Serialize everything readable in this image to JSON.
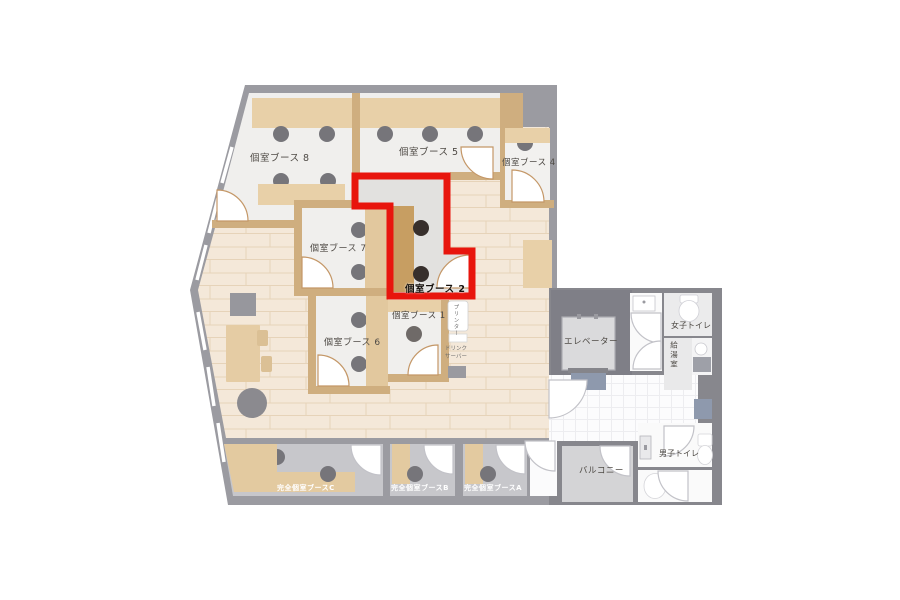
{
  "floor_plan": {
    "booths": {
      "booth8": "個室ブース 8",
      "booth5": "個室ブース 5",
      "booth4": "個室ブース 4",
      "booth7": "個室ブース 7",
      "booth2": "個室ブース 2",
      "booth6": "個室ブース 6",
      "booth1": "個室ブース 1",
      "boothC": "完全個室ブースC",
      "boothB": "完全個室ブースB",
      "boothA": "完全個室ブースA"
    },
    "facilities": {
      "elevator": "エレベーター",
      "balcony": "バルコニー",
      "womens_toilet": "女子トイレ",
      "mens_toilet": "男子トイレ",
      "kitchenette": "給湯室",
      "printer": "プリンター",
      "drink_server_line1": "ドリンク",
      "drink_server_line2": "サーバー"
    },
    "highlight": {
      "selected_booth": "個室ブース 2",
      "color": "#e8150d"
    },
    "colors": {
      "wall": "#9b9ba1",
      "wall_dark": "#87878d",
      "wood_floor": "#f4e8d9",
      "plank_line": "#e6d3b9",
      "booth_floor": "#f0efed",
      "booth2_floor": "#e2e1df",
      "desk": "#e8d0a8",
      "desk_dark": "#c79e62",
      "divider_wall": "#cfae7f",
      "lower_booth_floor": "#c7c7cb",
      "seat": "#76757a",
      "seat_highlight": "#372f2c",
      "mat": "#8e99ad",
      "balcony_floor": "#d4d4d6"
    }
  }
}
